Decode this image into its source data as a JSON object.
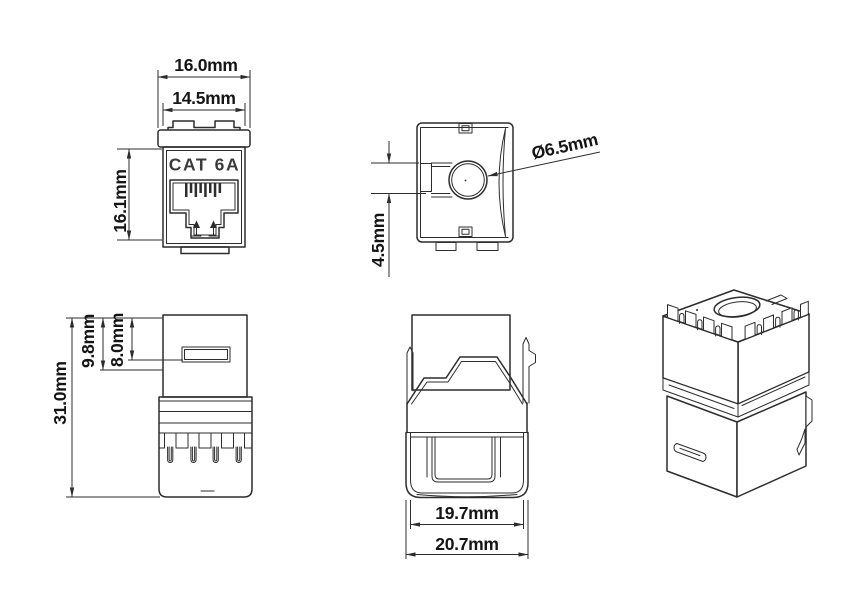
{
  "product_label": "CAT 6A",
  "views": {
    "front": {
      "width_outer": "16.0mm",
      "width_inner": "14.5mm",
      "height": "16.1mm"
    },
    "top": {
      "hole_diameter": "Ø6.5mm",
      "slot_offset": "4.5mm"
    },
    "side": {
      "total_height": "31.0mm",
      "cap_height": "9.8mm",
      "slot_depth": "8.0mm"
    },
    "rear": {
      "width_inner": "19.7mm",
      "width_outer": "20.7mm"
    }
  },
  "colors": {
    "line": "#2d2d2d",
    "dimension_text": "#151515",
    "label_text": "#3b3b3b",
    "background": "#ffffff"
  }
}
